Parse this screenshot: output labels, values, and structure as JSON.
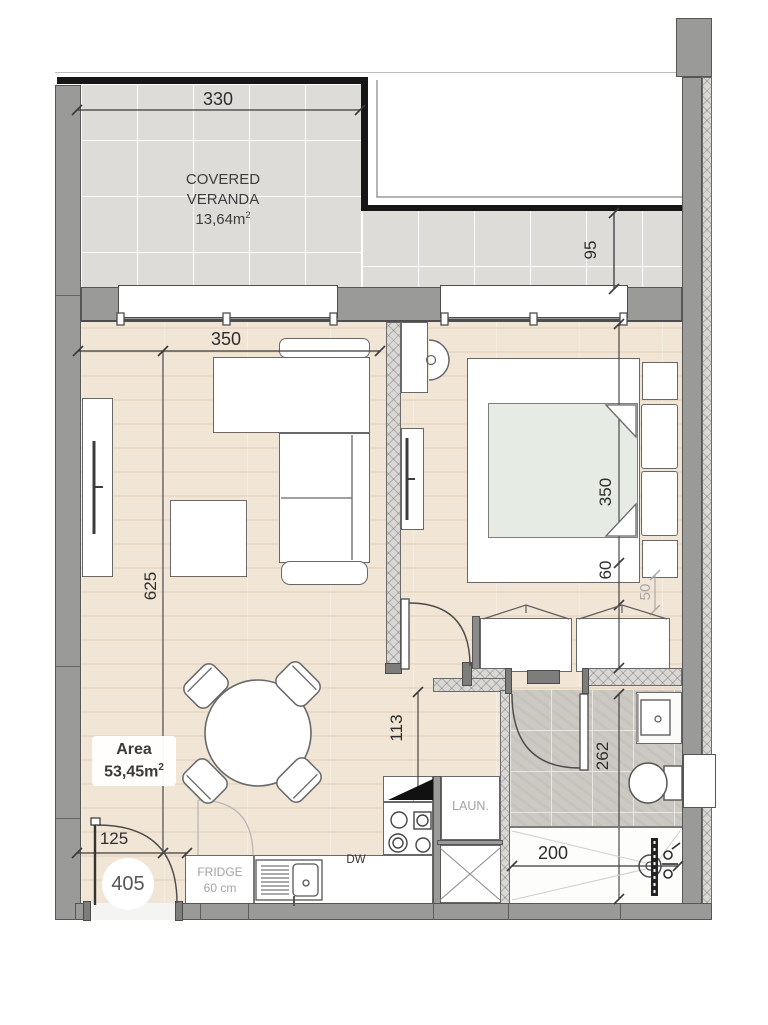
{
  "plan": {
    "unit_number": "405",
    "veranda": {
      "name_line1": "COVERED",
      "name_line2": "VERANDA",
      "area_value": "13,64m",
      "area_sup": "2"
    },
    "area_box": {
      "label": "Area",
      "value": "53,45m",
      "sup": "2"
    },
    "kitchen": {
      "fridge_line1": "FRIDGE",
      "fridge_line2": "60 cm",
      "dishwasher": "DW",
      "laundry": "LAUN."
    },
    "dimensions": {
      "veranda_width": "330",
      "veranda_depth": "95",
      "living_width": "350",
      "living_length": "625",
      "bedroom_length": "350",
      "bedroom_gap": "60",
      "wardrobe_depth": "50",
      "kitchen_passage": "113",
      "bathroom_length": "262",
      "shower_width": "200",
      "entry_width": "125"
    },
    "colors": {
      "wall": "#9a9a99",
      "wood_floor": "#f1e5d6",
      "veranda_tile": "#dddcd9",
      "bath_tile": "#ccc9c3",
      "mattress": "#e6ece4",
      "railing": "#161616"
    }
  }
}
